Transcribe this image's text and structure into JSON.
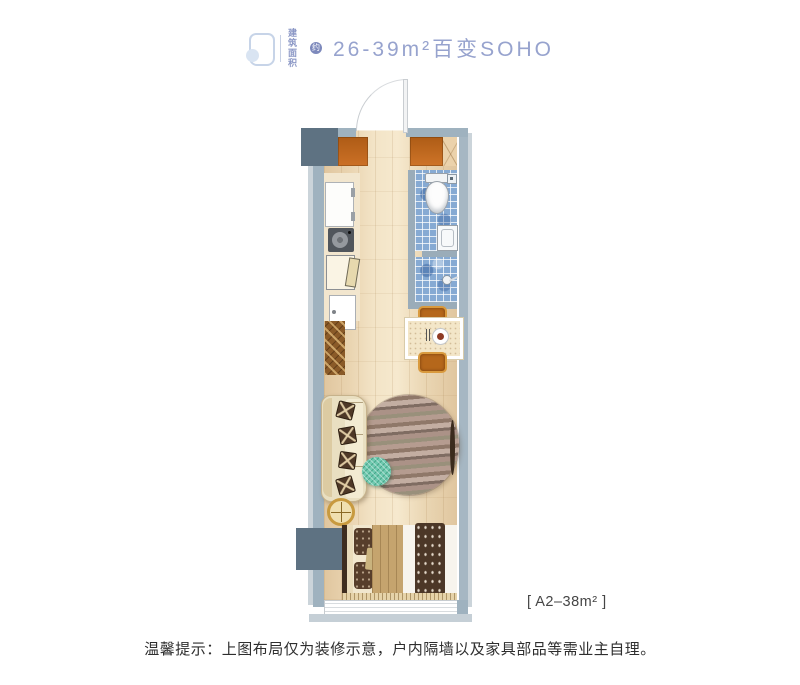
{
  "header": {
    "logo_icon": "building-outline-icon",
    "area_label": "建筑面积",
    "area_approx_badge": "约",
    "title": "26-39m²百变SOHO"
  },
  "floorplan": {
    "unit_label": "[ A2–38m² ]",
    "elements": [
      "entry-door",
      "structural-column-top",
      "structural-column-bottom",
      "entry-wardrobe-left",
      "entry-wardrobe-right",
      "entry-cabinet-wood",
      "fridge",
      "gas-stove",
      "kitchen-sink",
      "cutting-board",
      "washing-machine",
      "ladder-shelf",
      "bathroom-tiles",
      "toilet",
      "floor-drain",
      "washbasin",
      "shower",
      "dining-table",
      "dining-chair-top",
      "dining-chair-bottom",
      "plate",
      "cutlery",
      "sofa",
      "throw-pillows",
      "round-rug",
      "teal-pouf",
      "side-table",
      "wall-tv",
      "bed",
      "bed-pillows",
      "blanket",
      "floral-runner",
      "bed-bench",
      "balcony-window"
    ]
  },
  "footer": {
    "tip": "温馨提示：上图布局仅为装修示意，户内隔墙以及家具部品等需业主自理。"
  },
  "colors": {
    "title_blue": "#97A3CE",
    "wall_gray": "#9FB2BF",
    "column_slate": "#5E7282",
    "floor_wood": "#EFDDBE",
    "cabinet_orange": "#C1671F",
    "tile_blue": "#86AAD3",
    "pouf_teal": "#6FC9AF"
  }
}
